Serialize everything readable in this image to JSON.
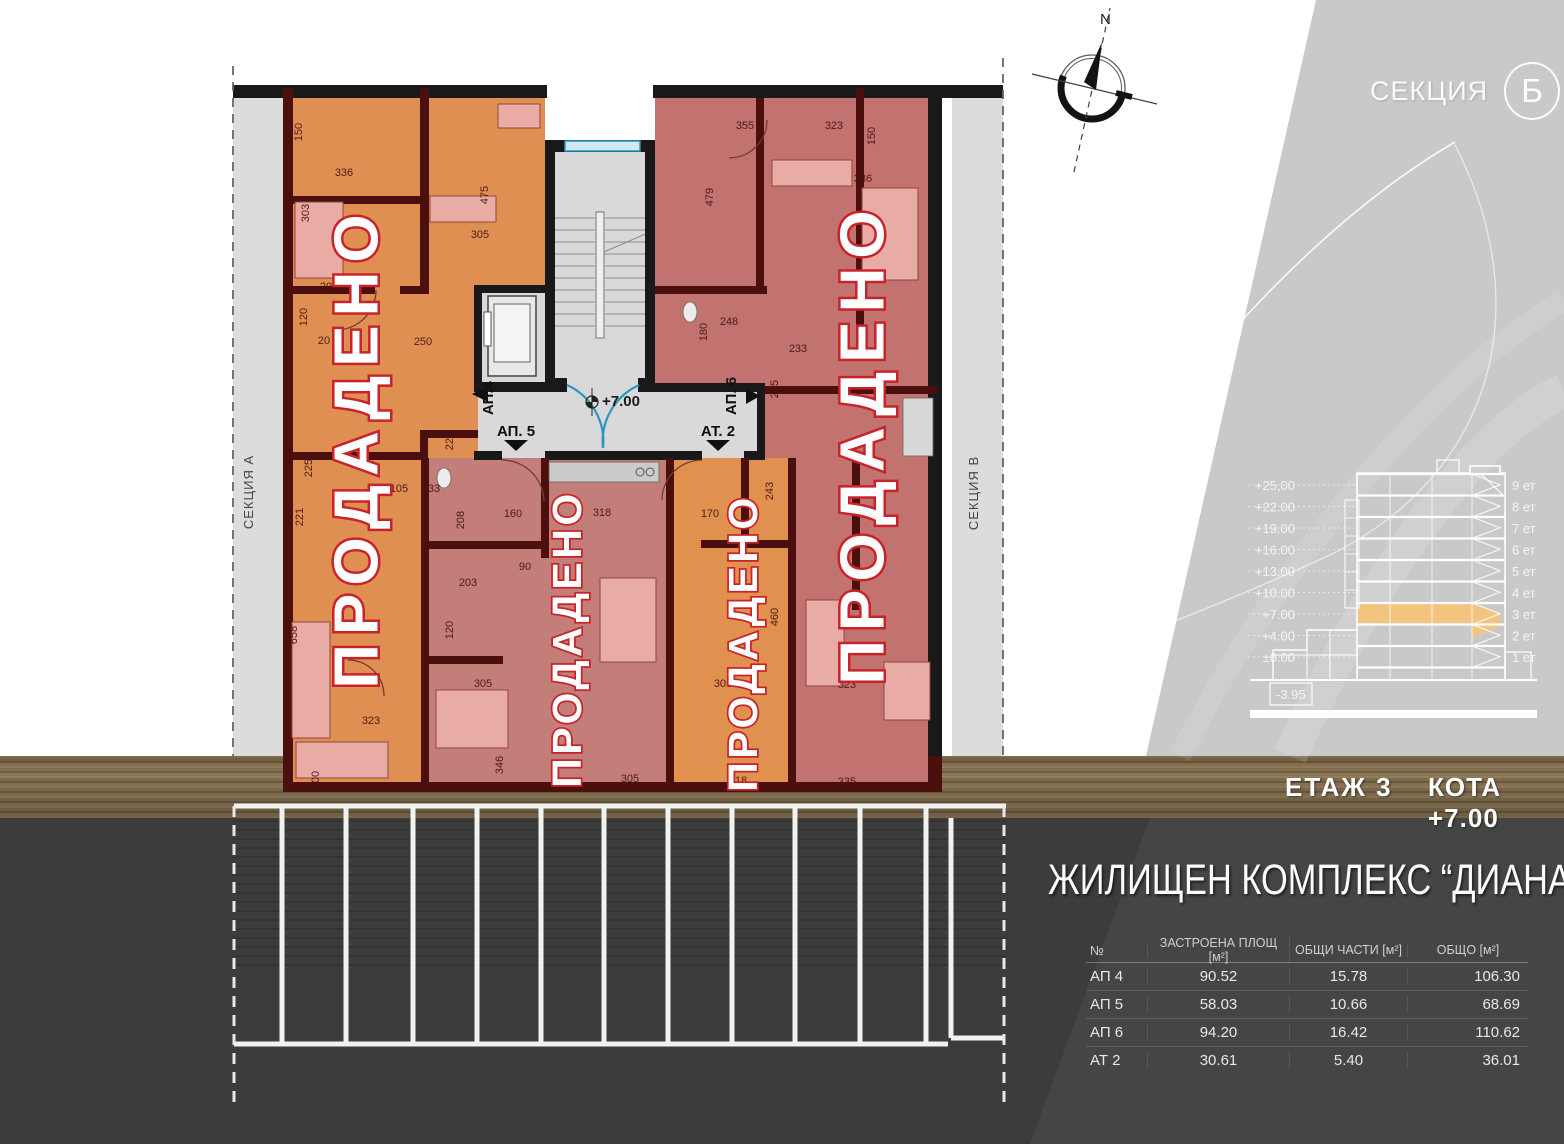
{
  "header": {
    "section_prefix": "СЕКЦИЯ",
    "section_letter": "Б"
  },
  "compass": {
    "north": "N"
  },
  "strips": {
    "left": "СЕКЦИЯ А",
    "right": "СЕКЦИЯ В"
  },
  "plan": {
    "sold_labels": [
      "ПРОДАДЕНО",
      "ПРОДАДЕНО",
      "ПРОДАДЕНО",
      "ПРОДАДЕНО"
    ],
    "level_marker": "+7.00",
    "units": [
      {
        "label": "АП.4"
      },
      {
        "label": "АП. 5"
      },
      {
        "label": "АТ. 2"
      },
      {
        "label": "АП. 6"
      }
    ],
    "dimensions": [
      {
        "t": "150",
        "x": 302,
        "y": 132,
        "r": -90
      },
      {
        "t": "336",
        "x": 344,
        "y": 176,
        "r": 0
      },
      {
        "t": "303",
        "x": 309,
        "y": 213,
        "r": -90
      },
      {
        "t": "475",
        "x": 488,
        "y": 195,
        "r": -90
      },
      {
        "t": "305",
        "x": 480,
        "y": 238,
        "r": 0
      },
      {
        "t": "120",
        "x": 307,
        "y": 317,
        "r": -90
      },
      {
        "t": "20",
        "x": 326,
        "y": 290,
        "r": 0
      },
      {
        "t": "20",
        "x": 324,
        "y": 344,
        "r": 0
      },
      {
        "t": "250",
        "x": 423,
        "y": 345,
        "r": 0
      },
      {
        "t": "225",
        "x": 312,
        "y": 468,
        "r": -90
      },
      {
        "t": "221",
        "x": 303,
        "y": 517,
        "r": -90
      },
      {
        "t": "105",
        "x": 399,
        "y": 492,
        "r": 0
      },
      {
        "t": "133",
        "x": 431,
        "y": 492,
        "r": 0
      },
      {
        "t": "228",
        "x": 453,
        "y": 441,
        "r": -90
      },
      {
        "t": "208",
        "x": 464,
        "y": 520,
        "r": -90
      },
      {
        "t": "160",
        "x": 513,
        "y": 517,
        "r": 0
      },
      {
        "t": "318",
        "x": 602,
        "y": 516,
        "r": 0
      },
      {
        "t": "90",
        "x": 525,
        "y": 570,
        "r": 0
      },
      {
        "t": "203",
        "x": 468,
        "y": 586,
        "r": 0
      },
      {
        "t": "120",
        "x": 453,
        "y": 630,
        "r": -90
      },
      {
        "t": "305",
        "x": 483,
        "y": 687,
        "r": 0
      },
      {
        "t": "658",
        "x": 297,
        "y": 635,
        "r": -90
      },
      {
        "t": "323",
        "x": 371,
        "y": 724,
        "r": 0
      },
      {
        "t": "100",
        "x": 319,
        "y": 780,
        "r": -90
      },
      {
        "t": "346",
        "x": 503,
        "y": 765,
        "r": -90
      },
      {
        "t": "305",
        "x": 630,
        "y": 782,
        "r": 0
      },
      {
        "t": "318",
        "x": 738,
        "y": 784,
        "r": 0
      },
      {
        "t": "335",
        "x": 847,
        "y": 785,
        "r": 0
      },
      {
        "t": "355",
        "x": 745,
        "y": 129,
        "r": 0
      },
      {
        "t": "323",
        "x": 834,
        "y": 129,
        "r": 0
      },
      {
        "t": "150",
        "x": 875,
        "y": 136,
        "r": -90
      },
      {
        "t": "336",
        "x": 863,
        "y": 182,
        "r": 0
      },
      {
        "t": "479",
        "x": 713,
        "y": 197,
        "r": -90
      },
      {
        "t": "248",
        "x": 729,
        "y": 325,
        "r": 0
      },
      {
        "t": "180",
        "x": 707,
        "y": 332,
        "r": -90
      },
      {
        "t": "233",
        "x": 798,
        "y": 352,
        "r": 0
      },
      {
        "t": "295",
        "x": 778,
        "y": 389,
        "r": -90
      },
      {
        "t": "243",
        "x": 773,
        "y": 491,
        "r": -90
      },
      {
        "t": "170",
        "x": 710,
        "y": 517,
        "r": 0
      },
      {
        "t": "460",
        "x": 778,
        "y": 617,
        "r": -90
      },
      {
        "t": "305",
        "x": 723,
        "y": 687,
        "r": 0
      },
      {
        "t": "323",
        "x": 847,
        "y": 688,
        "r": 0
      }
    ]
  },
  "section_diagram": {
    "elevations": [
      "+25,00",
      "+22.00",
      "+19.00",
      "+16.00",
      "+13.00",
      "+10.00",
      "+7.00",
      "+4.00",
      "±0.00"
    ],
    "floors": [
      "9 ет",
      "8 ет",
      "7 ет",
      "6 ет",
      "5 ет",
      "4 ет",
      "3 ет",
      "2 ет",
      "1 ет"
    ],
    "basement": "-3.95",
    "highlighted_floor": "3 ет"
  },
  "status": {
    "floor_label": "ЕТАЖ  3",
    "elevation_label": "КОТА +7.00"
  },
  "title": "ЖИЛИЩЕН КОМПЛЕКС  “ДИАНА”",
  "table": {
    "headers": [
      "№",
      "ЗАСТРОЕНА ПЛОЩ [м²]",
      "ОБЩИ ЧАСТИ [м²]",
      "ОБЩО [м²]"
    ],
    "rows": [
      [
        "АП 4",
        "90.52",
        "15.78",
        "106.30"
      ],
      [
        "АП 5",
        "58.03",
        "10.66",
        "68.69"
      ],
      [
        "АП 6",
        "94.20",
        "16.42",
        "110.62"
      ],
      [
        "АТ 2",
        "30.61",
        "5.40",
        "36.01"
      ]
    ]
  },
  "colors": {
    "sold_red": "#c8232a",
    "orange_unit": "#df8f52",
    "pink_unit": "#c47e79",
    "wall_maroon": "#4b100e",
    "floor_highlight": "#f2c480",
    "door_blue": "#2b97c0",
    "wood": "#84704f",
    "asphalt": "#3c3c3a",
    "panel_gray": "#c9c9c9"
  }
}
